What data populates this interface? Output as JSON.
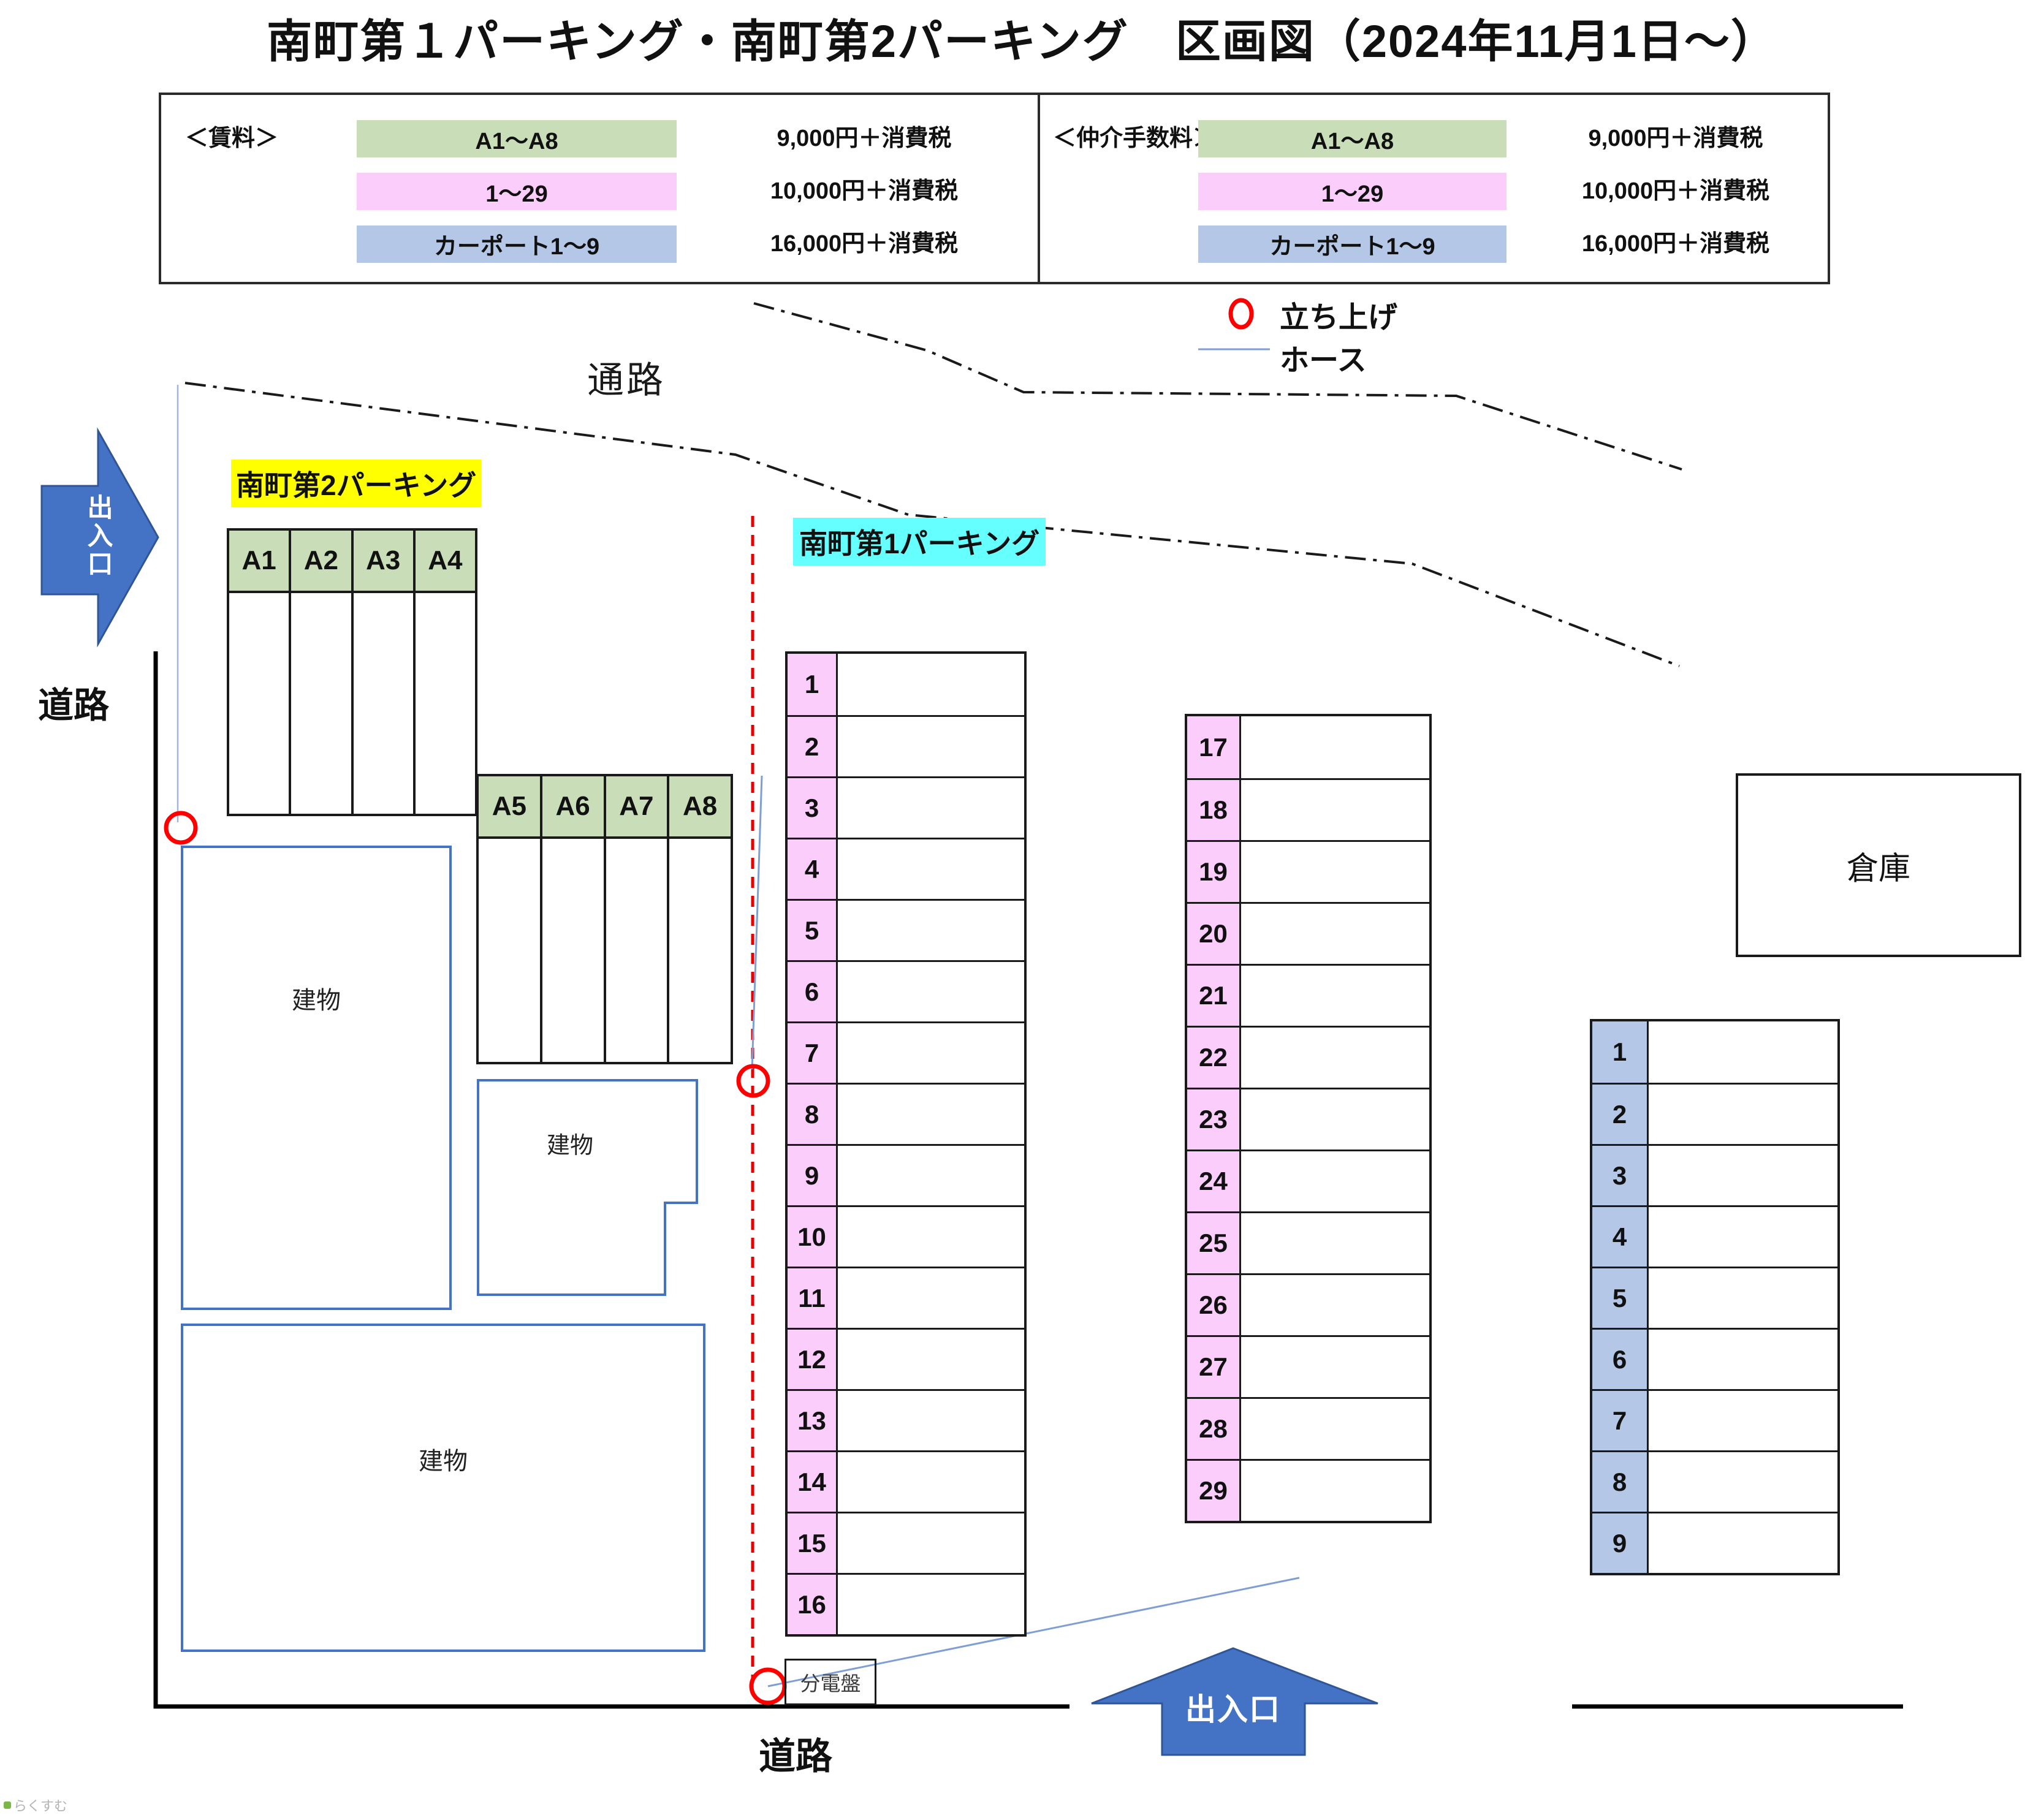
{
  "title": "南町第１パーキング・南町第2パーキング　区画図（2024年11月1日～）",
  "watermark": "らくすむ",
  "colors": {
    "green": "#C9DEB8",
    "pink": "#FACDFA",
    "blue": "#B4C7E7",
    "yellow": "#FFFF00",
    "cyan": "#66FFFF",
    "arrowfill": "#4472C4",
    "arrowedge": "#2F5597",
    "building": "#4472C4",
    "hose": "#7F9FD4",
    "red": "#FF0000",
    "reddash": "#E60000",
    "ink": "#1A1A1A"
  },
  "legend": {
    "rent": {
      "heading": "＜賃料＞",
      "rows": [
        {
          "label": "A1～A8",
          "price": "9,000円＋消費税",
          "color_key": "green"
        },
        {
          "label": "1～29",
          "price": "10,000円＋消費税",
          "color_key": "pink"
        },
        {
          "label": "カーポート1～9",
          "price": "16,000円＋消費税",
          "color_key": "blue"
        }
      ]
    },
    "fee": {
      "heading": "＜仲介手数料＞",
      "rows": [
        {
          "label": "A1～A8",
          "price": "9,000円＋消費税",
          "color_key": "green"
        },
        {
          "label": "1～29",
          "price": "10,000円＋消費税",
          "color_key": "pink"
        },
        {
          "label": "カーポート1～9",
          "price": "16,000円＋消費税",
          "color_key": "blue"
        }
      ]
    }
  },
  "map": {
    "lot2_label": "南町第2パーキング",
    "lot1_label": "南町第1パーキング",
    "passage": "通路",
    "road_left": "道路",
    "road_bottom": "道路",
    "entrance_left": "出入口",
    "entrance_bottom": "出入口",
    "building": "建物",
    "warehouse": "倉庫",
    "panel": "分電盤",
    "riser_line1": "立ち上げ",
    "riser_line2": "ホース",
    "spaces": {
      "a_top": [
        "A1",
        "A2",
        "A3",
        "A4"
      ],
      "a_bottom": [
        "A5",
        "A6",
        "A7",
        "A8"
      ],
      "p1": [
        "1",
        "2",
        "3",
        "4",
        "5",
        "6",
        "7",
        "8",
        "9",
        "10",
        "11",
        "12",
        "13",
        "14",
        "15",
        "16"
      ],
      "p17": [
        "17",
        "18",
        "19",
        "20",
        "21",
        "22",
        "23",
        "24",
        "25",
        "26",
        "27",
        "28",
        "29"
      ],
      "carport": [
        "1",
        "2",
        "3",
        "4",
        "5",
        "6",
        "7",
        "8",
        "9"
      ]
    }
  }
}
